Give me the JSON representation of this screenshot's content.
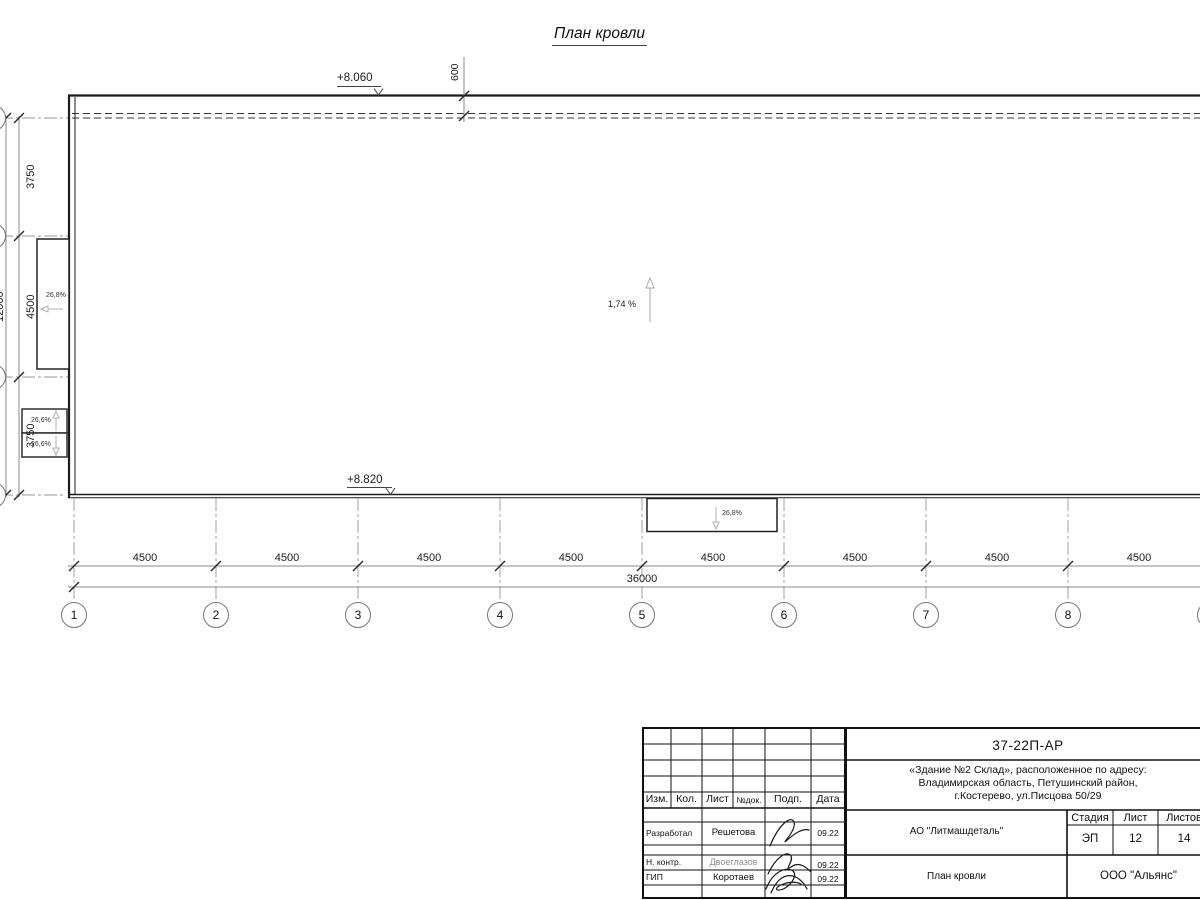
{
  "title": "План кровли",
  "drawing": {
    "elevation_top": "+8.060",
    "elevation_bottom": "+8.820",
    "parapet_offset": "600",
    "slope_main": "1,74 %",
    "slope_left_canopy": "26,8%",
    "slope_bottom_canopy": "26,8%",
    "slope_small_top": "26,6%",
    "slope_small_bottom": "26,6%",
    "left_dims": [
      "3750",
      "4500",
      "3750"
    ],
    "left_total": "12000",
    "bottom_spans": [
      "4500",
      "4500",
      "4500",
      "4500",
      "4500",
      "4500",
      "4500",
      "4500"
    ],
    "bottom_total": "36000",
    "grid_bubbles": [
      "1",
      "2",
      "3",
      "4",
      "5",
      "6",
      "7",
      "8"
    ]
  },
  "titleblock": {
    "doc_number": "37-22П-АР",
    "address_line1": "«Здание №2 Склад», расположенное по адресу:",
    "address_line2": "Владимирская область, Петушинский район,",
    "address_line3": "г.Костерево, ул.Писцова 50/29",
    "client": "АО \"Литмашдеталь\"",
    "sheet_title": "План кровли",
    "company": "ООО \"Альянс\"",
    "stage_label": "Стадия",
    "stage_value": "ЭП",
    "sheet_label": "Лист",
    "sheet_value": "12",
    "sheets_label": "Листов",
    "sheets_value": "14",
    "header": {
      "izm": "Изм.",
      "kol": "Кол.",
      "list": "Лист",
      "ndok": "№док.",
      "podp": "Подп.",
      "data": "Дата"
    },
    "roles": [
      {
        "role": "Разработал",
        "name": "Решетова",
        "date": "09.22"
      },
      {
        "role": "Н. контр.",
        "name": "Двоеглазов",
        "date": "09.22"
      },
      {
        "role": "ГИП",
        "name": "Коротаев",
        "date": "09.22"
      }
    ]
  }
}
